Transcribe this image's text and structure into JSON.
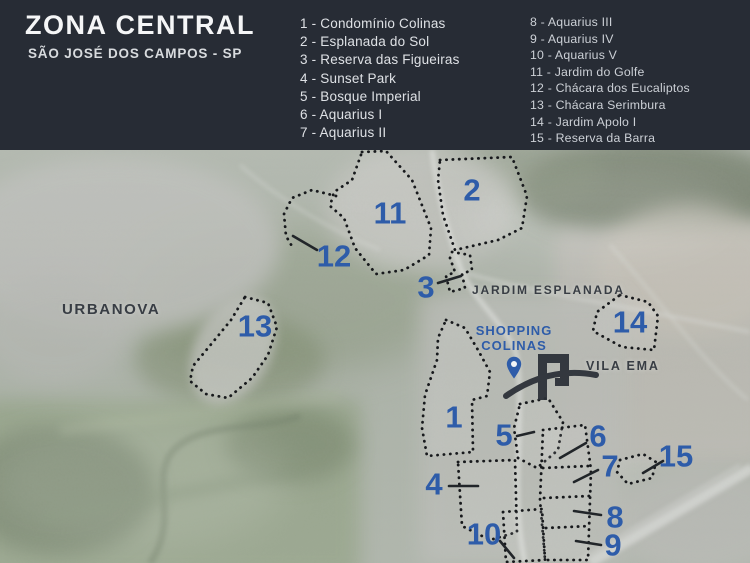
{
  "header": {
    "title": "ZONA CENTRAL",
    "subtitle": "SÃO JOSÉ DOS CAMPOS - SP",
    "bg_color": "#272c35",
    "legend_col1": [
      "1 - Condomínio Colinas",
      "2 - Esplanada do Sol",
      "3 - Reserva das Figueiras",
      "4 - Sunset Park",
      "5 - Bosque Imperial",
      "6 - Aquarius I",
      "7 - Aquarius II"
    ],
    "legend_col2": [
      "8 - Aquarius III",
      "9 - Aquarius IV",
      "10 - Aquarius V",
      "11 - Jardim do Golfe",
      "12 - Chácara dos Eucaliptos",
      "13 - Chácara Serimbura",
      "14 - Jardim Apolo I",
      "15 - Reserva da Barra"
    ]
  },
  "map": {
    "accent_blue": "#2e5ca9",
    "dark_label_color": "#383d44",
    "labels": {
      "urbanova": "URBANOVA",
      "jardim_esplanada": "JARDIM ESPLANADA",
      "vila_ema": "VILA EMA",
      "shopping_line1": "SHOPPING",
      "shopping_line2": "COLINAS"
    },
    "icons": {
      "pin": "location-pin-icon",
      "logo": "colinas-arch-logo"
    },
    "markers": [
      {
        "n": "11",
        "x": 390,
        "y": 213
      },
      {
        "n": "2",
        "x": 472,
        "y": 190
      },
      {
        "n": "12",
        "x": 334,
        "y": 256,
        "leader": [
          293,
          236,
          317,
          250
        ]
      },
      {
        "n": "3",
        "x": 426,
        "y": 287,
        "leader": [
          438,
          283,
          461,
          276
        ]
      },
      {
        "n": "13",
        "x": 255,
        "y": 326
      },
      {
        "n": "14",
        "x": 630,
        "y": 322
      },
      {
        "n": "1",
        "x": 454,
        "y": 417
      },
      {
        "n": "5",
        "x": 504,
        "y": 435,
        "leader": [
          517,
          436,
          534,
          432
        ]
      },
      {
        "n": "6",
        "x": 598,
        "y": 436,
        "leader": [
          560,
          458,
          586,
          443
        ]
      },
      {
        "n": "7",
        "x": 610,
        "y": 466,
        "leader": [
          574,
          482,
          598,
          470
        ]
      },
      {
        "n": "15",
        "x": 676,
        "y": 456,
        "leader": [
          643,
          473,
          663,
          461
        ]
      },
      {
        "n": "4",
        "x": 434,
        "y": 484,
        "leader": [
          449,
          486,
          478,
          486
        ]
      },
      {
        "n": "8",
        "x": 615,
        "y": 517,
        "leader": [
          574,
          511,
          601,
          515
        ]
      },
      {
        "n": "10",
        "x": 484,
        "y": 534,
        "leader": [
          500,
          541,
          514,
          558
        ]
      },
      {
        "n": "9",
        "x": 613,
        "y": 545,
        "leader": [
          576,
          541,
          601,
          545
        ]
      }
    ]
  }
}
